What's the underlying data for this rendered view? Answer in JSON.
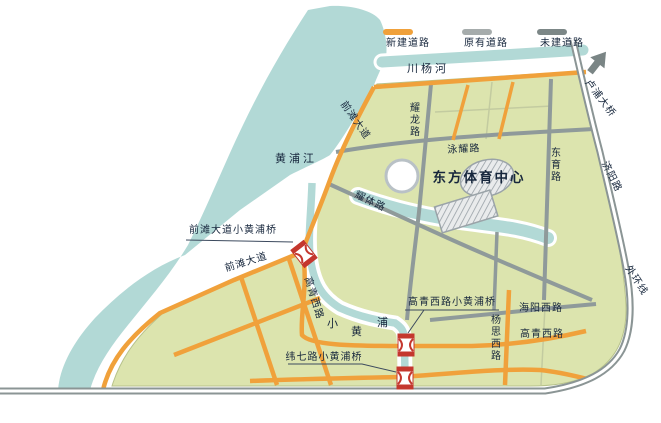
{
  "map": {
    "legend": {
      "items": [
        {
          "label": "新建道路",
          "color": "#f0a13b"
        },
        {
          "label": "原有道路",
          "color": "#a6acac"
        },
        {
          "label": "未建道路",
          "color": "#7c8787"
        }
      ]
    },
    "labels": {
      "huangpu_river": "黄浦江",
      "chuanyang_river": "川杨河",
      "xiaohuangpu_char1": "小",
      "xiaohuangpu_char2": "黄",
      "xiaohuangpu_char3": "浦",
      "sports_center": "东方体育中心",
      "qiantan_avenue_upper": "前滩大道",
      "qiantan_avenue_lower": "前滩大道",
      "yaolong_road": "耀龙路",
      "yongyao_road": "泳耀路",
      "yaoti_road": "耀体路",
      "dongyu_road": "东育路",
      "gaoqing_west_road_diag": "高青西路",
      "gaoqing_west_road_h": "高青西路",
      "haiyang_west_road": "海阳西路",
      "yangsi_west_road": "杨思西路",
      "jiyang_road": "济阳路",
      "outer_ring": "外环线",
      "lupu_bridge": "卢浦大桥",
      "bridge_qiantan": "前滩大道小黄浦桥",
      "bridge_gaoqing": "高青西路小黄浦桥",
      "bridge_weiqi": "纬七路小黄浦桥"
    },
    "colors": {
      "water": "#b2d9d6",
      "land": "#dce4ae",
      "road_new": "#f0a13b",
      "road_existing": "#8f9a9a",
      "ring_road": "#8b9595",
      "bridge_marker": "#c4372e",
      "text": "#16263c"
    }
  }
}
